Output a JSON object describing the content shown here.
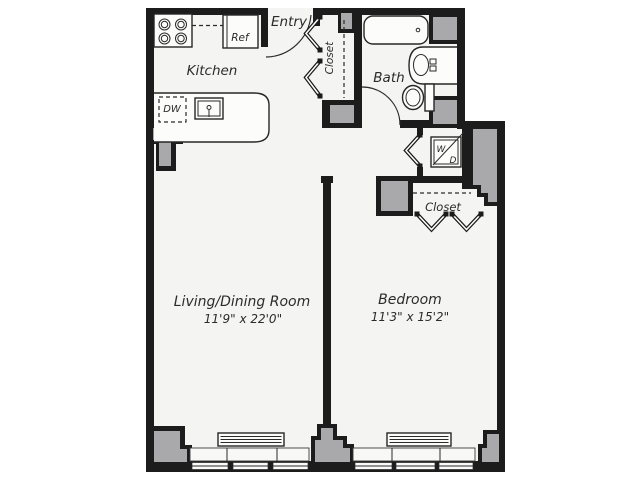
{
  "plan": {
    "labels": {
      "kitchen": "Kitchen",
      "entry": "Entry",
      "entry_closet": "Closet",
      "bath": "Bath",
      "bedroom_closet": "Closet",
      "living_room": "Living/Dining Room",
      "living_room_dims": "11'9\" x 22'0\"",
      "bedroom": "Bedroom",
      "bedroom_dims": "11'3\" x 15'2\"",
      "refrigerator": "Ref",
      "dishwasher": "DW",
      "washer": "W",
      "dryer": "D"
    },
    "colors": {
      "wall": "#1c1c1c",
      "column": "#a9a9ab",
      "floor": "#f4f4f2",
      "text": "#2b2b2b"
    }
  }
}
